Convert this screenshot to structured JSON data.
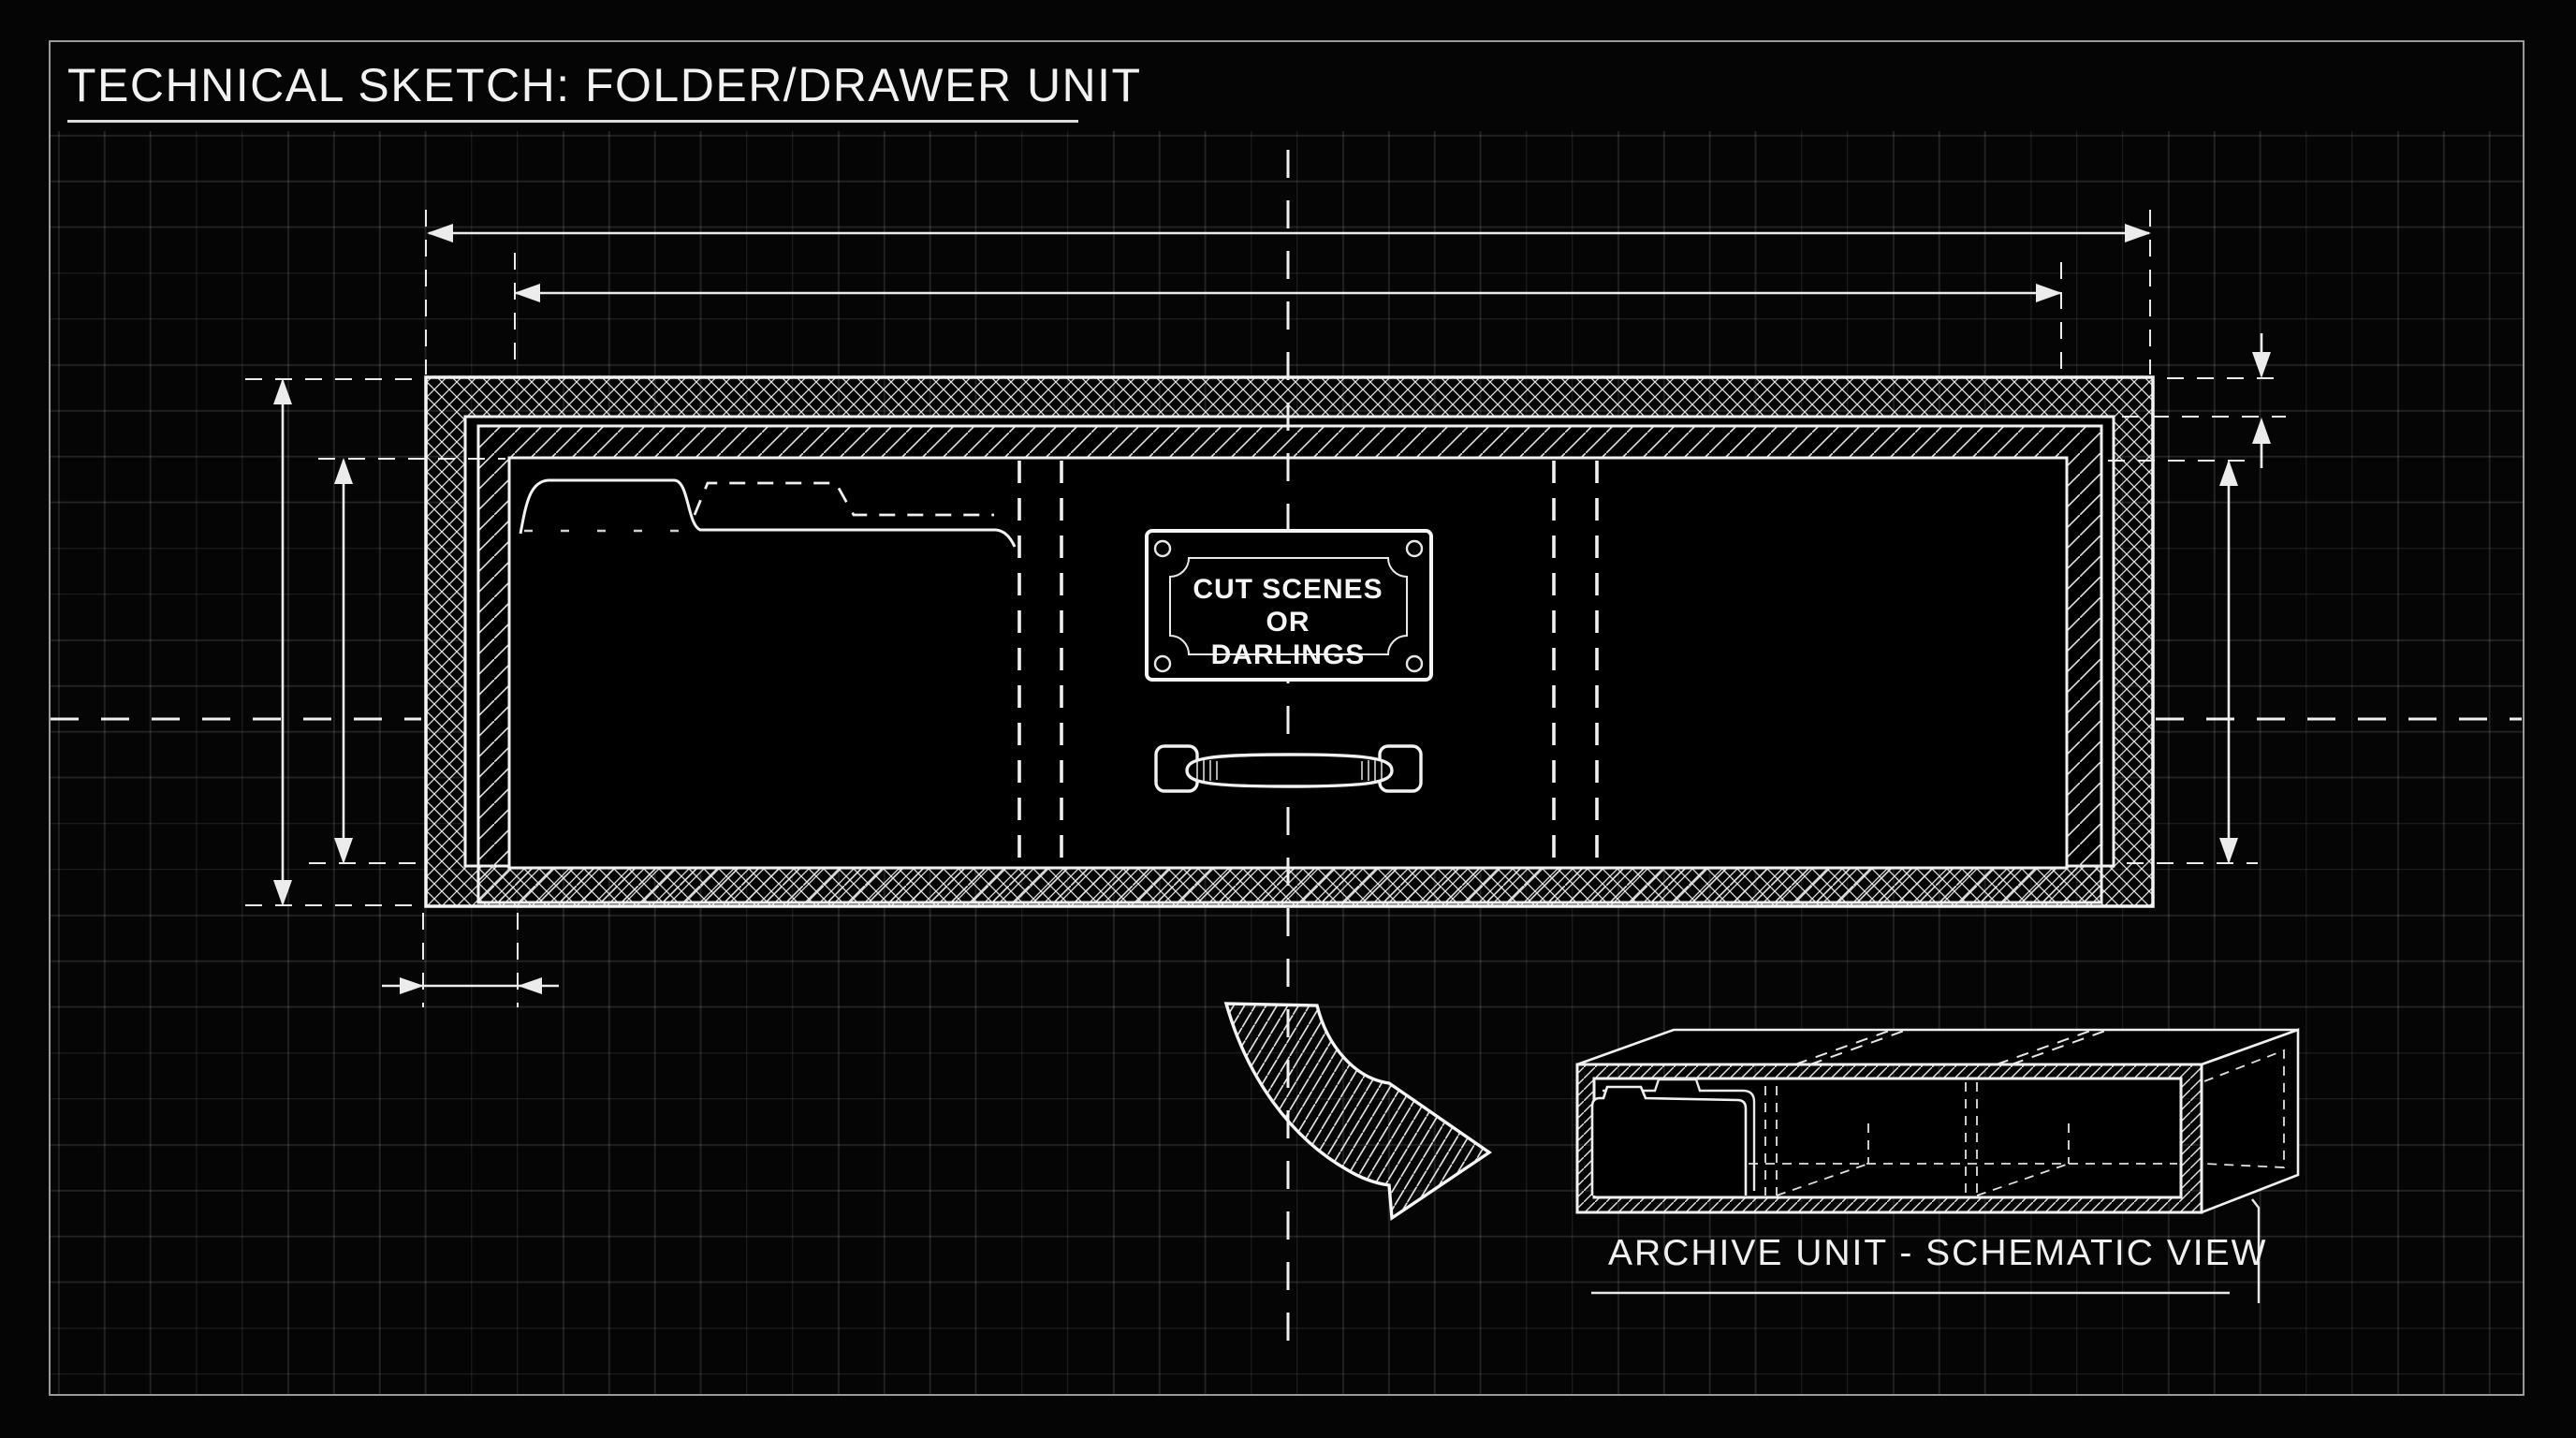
{
  "page": {
    "title": "TECHNICAL SKETCH: FOLDER/DRAWER UNIT"
  },
  "drawer_front_view": {
    "name_plate": {
      "line1": "CUT SCENES",
      "line2": "OR",
      "line3": "DARLINGS"
    }
  },
  "iso_view": {
    "caption": "ARCHIVE UNIT - SCHEMATIC VIEW"
  },
  "colors": {
    "background": "#050505",
    "line_white": "#f0f0f0",
    "grid_line": "#232323",
    "page_border": "#9a9a9a"
  }
}
